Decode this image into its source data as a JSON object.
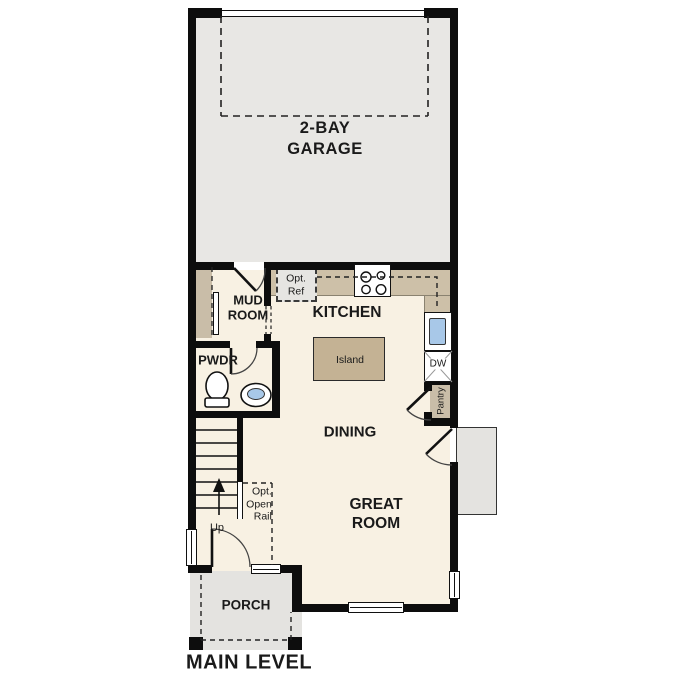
{
  "plan_title": "MAIN LEVEL",
  "labels": {
    "garage_l1": "2-BAY",
    "garage_l2": "GARAGE",
    "mud_l1": "MUD",
    "mud_l2": "ROOM",
    "kitchen": "KITCHEN",
    "island": "Island",
    "opt_ref_l1": "Opt.",
    "opt_ref_l2": "Ref",
    "pwdr": "PWDR",
    "dining": "DINING",
    "great_l1": "GREAT",
    "great_l2": "ROOM",
    "porch": "PORCH",
    "pantry": "Pantry",
    "dw": "DW",
    "up": "Up",
    "rail_l1": "Opt.",
    "rail_l2": "Open",
    "rail_l3": "Rail"
  },
  "colors": {
    "wall": "#0d0d0d",
    "interior_floor": "#f8f1e3",
    "garage_floor": "#e8e7e4",
    "porch_floor": "#e4e3e0",
    "counter": "#cdc0a8",
    "island": "#c4b294",
    "cabinet": "#c9bda8",
    "sink_water": "#a8c8e8",
    "text": "#1a1a1a"
  }
}
